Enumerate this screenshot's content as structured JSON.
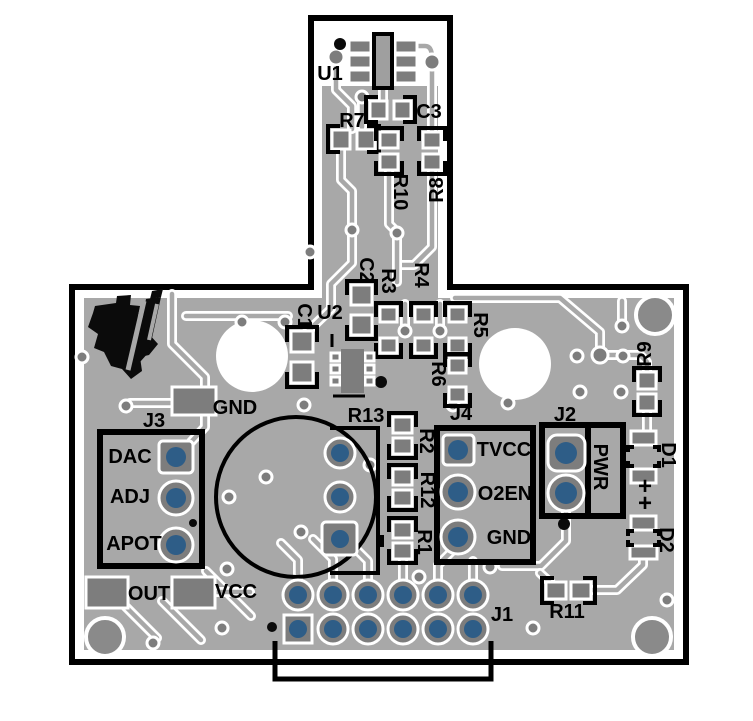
{
  "meta": {
    "image_type": "pcb-top-layer-layout",
    "brand_logo": "texas-instruments-logo"
  },
  "colors": {
    "copper": "#a8a8a8",
    "pad": "#7d7d7d",
    "disc": "#8a8a8a",
    "hole": "#2e5d87",
    "silkscreen": "#000000",
    "board_background": "#ffffff"
  },
  "connectors": {
    "J1": {
      "label": "J1",
      "pin_count": 12
    },
    "J2": {
      "label": "J2",
      "pins": [
        "PWR"
      ]
    },
    "J3": {
      "label": "J3",
      "pins": [
        "DAC",
        "ADJ",
        "APOT"
      ]
    },
    "J4": {
      "label": "J4",
      "pins": [
        "TVCC",
        "O2EN",
        "GND"
      ]
    }
  },
  "test_pads": [
    "GND",
    "OUT",
    "VCC"
  ],
  "designators": [
    "U1",
    "U2",
    "R1",
    "R2",
    "R3",
    "R4",
    "R5",
    "R6",
    "R7",
    "R8",
    "R9",
    "R10",
    "R11",
    "R12",
    "R13",
    "C1",
    "C2",
    "C3",
    "D1",
    "D2",
    "J1",
    "J2",
    "J3",
    "J4"
  ],
  "silkscreen_labels": [
    {
      "id": "U1",
      "text": "U1",
      "x": 330,
      "y": 74,
      "rot": 0
    },
    {
      "id": "R7",
      "text": "R7",
      "x": 352,
      "y": 121,
      "rot": 0
    },
    {
      "id": "C3",
      "text": "C3",
      "x": 429,
      "y": 112,
      "rot": 0
    },
    {
      "id": "R10",
      "text": "R10",
      "x": 400,
      "y": 192,
      "rot": 90
    },
    {
      "id": "R8",
      "text": "R8",
      "x": 437,
      "y": 190,
      "rot": -90
    },
    {
      "id": "C2",
      "text": "C2",
      "x": 366,
      "y": 270,
      "rot": 90
    },
    {
      "id": "R3",
      "text": "R3",
      "x": 388,
      "y": 281,
      "rot": 90
    },
    {
      "id": "R4",
      "text": "R4",
      "x": 421,
      "y": 275,
      "rot": 90
    },
    {
      "id": "C1",
      "text": "C1",
      "x": 304,
      "y": 316,
      "rot": 90
    },
    {
      "id": "U2",
      "text": "U2",
      "x": 330,
      "y": 313,
      "rot": 0
    },
    {
      "id": "R5",
      "text": "R5",
      "x": 480,
      "y": 325,
      "rot": 90
    },
    {
      "id": "R6",
      "text": "R6",
      "x": 438,
      "y": 374,
      "rot": 90
    },
    {
      "id": "GND1",
      "text": "GND",
      "x": 235,
      "y": 408,
      "rot": 0
    },
    {
      "id": "J3",
      "text": "J3",
      "x": 154,
      "y": 421,
      "rot": 0
    },
    {
      "id": "DAC",
      "text": "DAC",
      "x": 130,
      "y": 457,
      "rot": 0
    },
    {
      "id": "ADJ",
      "text": "ADJ",
      "x": 130,
      "y": 497,
      "rot": 0
    },
    {
      "id": "APOT",
      "text": "APOT",
      "x": 134,
      "y": 544,
      "rot": 0
    },
    {
      "id": "OUT",
      "text": "OUT",
      "x": 149,
      "y": 594,
      "rot": 0
    },
    {
      "id": "VCC",
      "text": "VCC",
      "x": 236,
      "y": 592,
      "rot": 0
    },
    {
      "id": "R13",
      "text": "R13",
      "x": 366,
      "y": 416,
      "rot": 0
    },
    {
      "id": "R2",
      "text": "R2",
      "x": 426,
      "y": 441,
      "rot": 90
    },
    {
      "id": "R12",
      "text": "R12",
      "x": 427,
      "y": 490,
      "rot": 90
    },
    {
      "id": "R1",
      "text": "R1",
      "x": 424,
      "y": 542,
      "rot": 90
    },
    {
      "id": "J4",
      "text": "J4",
      "x": 461,
      "y": 414,
      "rot": 0
    },
    {
      "id": "TVCC",
      "text": "TVCC",
      "x": 504,
      "y": 450,
      "rot": 0
    },
    {
      "id": "O2EN",
      "text": "O2EN",
      "x": 505,
      "y": 494,
      "rot": 0
    },
    {
      "id": "GND2",
      "text": "GND",
      "x": 509,
      "y": 538,
      "rot": 0
    },
    {
      "id": "J2",
      "text": "J2",
      "x": 565,
      "y": 415,
      "rot": 0
    },
    {
      "id": "PWR",
      "text": "PWR",
      "x": 600,
      "y": 467,
      "rot": 90
    },
    {
      "id": "R9",
      "text": "R9",
      "x": 645,
      "y": 354,
      "rot": -90
    },
    {
      "id": "D1",
      "text": "D1",
      "x": 668,
      "y": 455,
      "rot": 90
    },
    {
      "id": "PLUS1",
      "text": "+",
      "x": 645,
      "y": 487,
      "rot": 0,
      "size": 24
    },
    {
      "id": "PLUS2",
      "text": "+",
      "x": 645,
      "y": 504,
      "rot": 0,
      "size": 24
    },
    {
      "id": "D2",
      "text": "D2",
      "x": 666,
      "y": 540,
      "rot": 90
    },
    {
      "id": "R11",
      "text": "R11",
      "x": 567,
      "y": 612,
      "rot": 0
    },
    {
      "id": "J1",
      "text": "J1",
      "x": 502,
      "y": 615,
      "rot": 0
    }
  ]
}
